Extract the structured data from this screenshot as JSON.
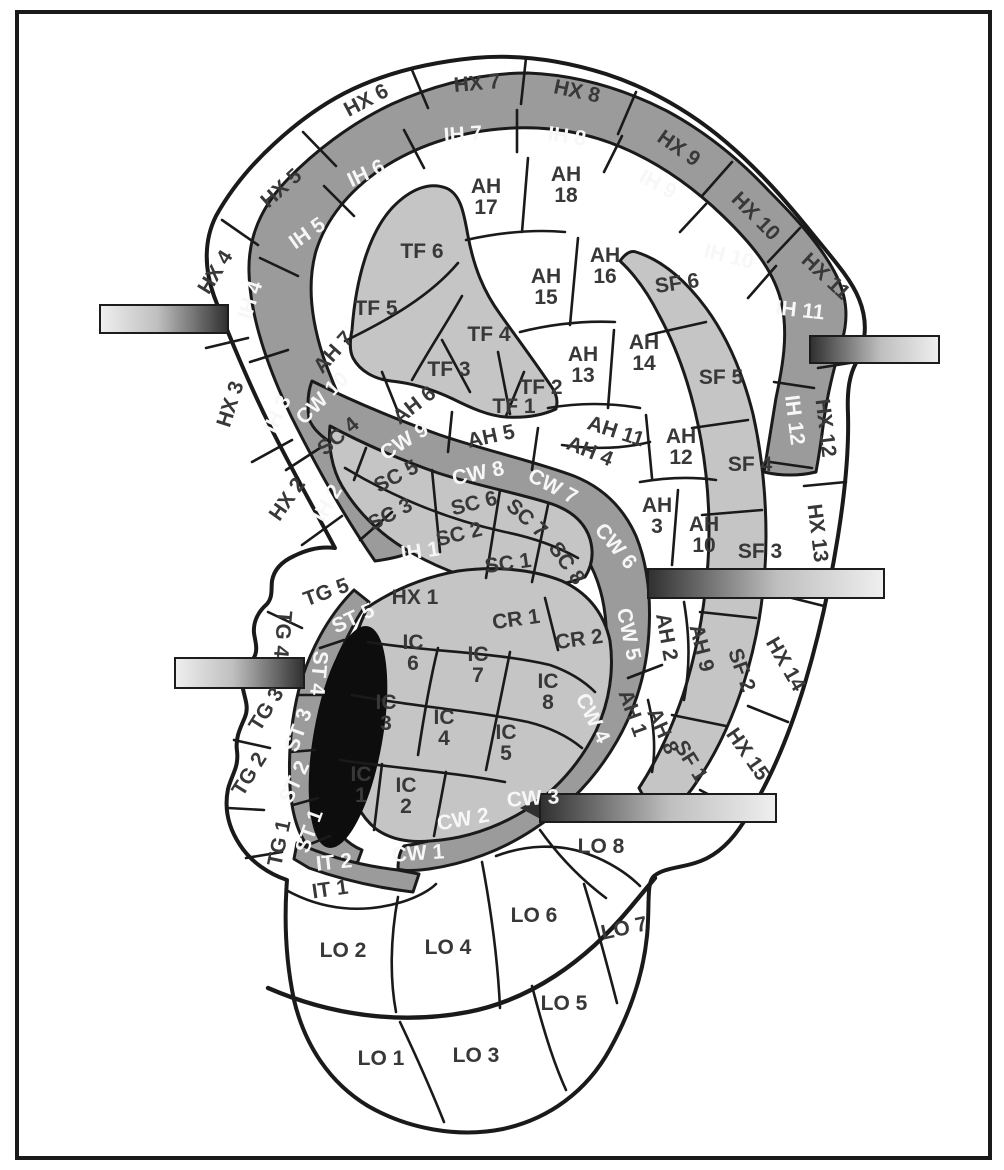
{
  "figure": {
    "kind": "auricular-zone-map"
  },
  "palette": {
    "ink": "#1a1a1a",
    "paper": "#ffffff",
    "dark_band": "#9b9b9b",
    "light_band": "#c5c5c5",
    "label_dark": "#383838",
    "label_light": "#f7f7f7",
    "pin_dark": "#2f2f2f",
    "pin_mid": "#bfbfbf",
    "pin_light": "#efefef"
  },
  "pins": [
    {
      "name": "pin-marker-1",
      "x": 100,
      "y": 305,
      "w": 128,
      "h": 28,
      "dir": "light-to-dark"
    },
    {
      "name": "pin-marker-2",
      "x": 810,
      "y": 336,
      "w": 129,
      "h": 27,
      "dir": "dark-to-light"
    },
    {
      "name": "pin-marker-3",
      "x": 648,
      "y": 569,
      "w": 236,
      "h": 29,
      "dir": "dark-to-light"
    },
    {
      "name": "pin-marker-4",
      "x": 175,
      "y": 658,
      "w": 129,
      "h": 30,
      "dir": "light-to-dark"
    },
    {
      "name": "pin-marker-5",
      "x": 540,
      "y": 794,
      "w": 236,
      "h": 28,
      "dir": "dark-to-light",
      "tip": true
    }
  ],
  "zones": [
    {
      "t": "HX 1",
      "x": 415,
      "y": 597,
      "r": 0,
      "c": "d"
    },
    {
      "t": "HX 2",
      "x": 287,
      "y": 499,
      "r": -55,
      "c": "d"
    },
    {
      "t": "HX 3",
      "x": 230,
      "y": 404,
      "r": -72,
      "c": "d"
    },
    {
      "t": "HX 4",
      "x": 215,
      "y": 272,
      "r": -58,
      "c": "d"
    },
    {
      "t": "HX 5",
      "x": 281,
      "y": 188,
      "r": -42,
      "c": "d"
    },
    {
      "t": "HX 6",
      "x": 366,
      "y": 100,
      "r": -28,
      "c": "d"
    },
    {
      "t": "HX 7",
      "x": 477,
      "y": 83,
      "r": -5,
      "c": "d"
    },
    {
      "t": "HX 8",
      "x": 577,
      "y": 91,
      "r": 12,
      "c": "d"
    },
    {
      "t": "HX 9",
      "x": 679,
      "y": 148,
      "r": 35,
      "c": "d"
    },
    {
      "t": "HX 10",
      "x": 756,
      "y": 216,
      "r": 45,
      "c": "d"
    },
    {
      "t": "HX 11",
      "x": 826,
      "y": 276,
      "r": 43,
      "c": "d"
    },
    {
      "t": "HX 12",
      "x": 826,
      "y": 428,
      "r": 83,
      "c": "d"
    },
    {
      "t": "HX 13",
      "x": 818,
      "y": 533,
      "r": 83,
      "c": "d"
    },
    {
      "t": "HX 14",
      "x": 786,
      "y": 664,
      "r": 60,
      "c": "d"
    },
    {
      "t": "HX 15",
      "x": 748,
      "y": 754,
      "r": 55,
      "c": "d"
    },
    {
      "t": "IH 1",
      "x": 420,
      "y": 551,
      "r": -8,
      "c": "w"
    },
    {
      "t": "IH 2",
      "x": 327,
      "y": 503,
      "r": -60,
      "c": "w"
    },
    {
      "t": "IH 3",
      "x": 277,
      "y": 414,
      "r": -65,
      "c": "w"
    },
    {
      "t": "IH 4",
      "x": 250,
      "y": 300,
      "r": -72,
      "c": "w"
    },
    {
      "t": "IH 5",
      "x": 307,
      "y": 233,
      "r": -35,
      "c": "w"
    },
    {
      "t": "IH 6",
      "x": 366,
      "y": 173,
      "r": -25,
      "c": "w"
    },
    {
      "t": "IH 7",
      "x": 463,
      "y": 134,
      "r": -4,
      "c": "w"
    },
    {
      "t": "IH 8",
      "x": 567,
      "y": 136,
      "r": 8,
      "c": "w"
    },
    {
      "t": "IH 9",
      "x": 658,
      "y": 184,
      "r": 28,
      "c": "w"
    },
    {
      "t": "IH 10",
      "x": 729,
      "y": 256,
      "r": 14,
      "c": "w"
    },
    {
      "t": "IH 11",
      "x": 800,
      "y": 310,
      "r": 6,
      "c": "w"
    },
    {
      "t": "IH 12",
      "x": 795,
      "y": 420,
      "r": 83,
      "c": "w"
    },
    {
      "t": "TF 1",
      "x": 514,
      "y": 406,
      "r": 0,
      "c": "d"
    },
    {
      "t": "TF 2",
      "x": 541,
      "y": 387,
      "r": 0,
      "c": "d"
    },
    {
      "t": "TF 3",
      "x": 449,
      "y": 369,
      "r": 0,
      "c": "d"
    },
    {
      "t": "TF 4",
      "x": 489,
      "y": 334,
      "r": 0,
      "c": "d"
    },
    {
      "t": "TF 5",
      "x": 376,
      "y": 308,
      "r": 0,
      "c": "d"
    },
    {
      "t": "TF 6",
      "x": 422,
      "y": 251,
      "r": 0,
      "c": "d"
    },
    {
      "t": [
        "AH",
        "17"
      ],
      "x": 486,
      "y": 196,
      "r": 0,
      "c": "d"
    },
    {
      "t": [
        "AH",
        "18"
      ],
      "x": 566,
      "y": 184,
      "r": 0,
      "c": "d"
    },
    {
      "t": [
        "AH",
        "15"
      ],
      "x": 546,
      "y": 286,
      "r": 0,
      "c": "d"
    },
    {
      "t": [
        "AH",
        "16"
      ],
      "x": 605,
      "y": 265,
      "r": 0,
      "c": "d"
    },
    {
      "t": [
        "AH",
        "13"
      ],
      "x": 583,
      "y": 364,
      "r": 0,
      "c": "d"
    },
    {
      "t": [
        "AH",
        "14"
      ],
      "x": 644,
      "y": 352,
      "r": 0,
      "c": "d"
    },
    {
      "t": "AH 11",
      "x": 616,
      "y": 431,
      "r": 18,
      "c": "d"
    },
    {
      "t": [
        "AH",
        "12"
      ],
      "x": 681,
      "y": 446,
      "r": 0,
      "c": "d"
    },
    {
      "t": [
        "AH",
        "3"
      ],
      "x": 657,
      "y": 515,
      "r": 0,
      "c": "d"
    },
    {
      "t": [
        "AH",
        "10"
      ],
      "x": 704,
      "y": 534,
      "r": 0,
      "c": "d"
    },
    {
      "t": "AH 4",
      "x": 590,
      "y": 451,
      "r": 22,
      "c": "d"
    },
    {
      "t": "AH 5",
      "x": 491,
      "y": 436,
      "r": -12,
      "c": "d"
    },
    {
      "t": "AH 6",
      "x": 414,
      "y": 405,
      "r": -38,
      "c": "d"
    },
    {
      "t": "AH 7",
      "x": 333,
      "y": 352,
      "r": -48,
      "c": "d"
    },
    {
      "t": "AH 2",
      "x": 667,
      "y": 637,
      "r": 80,
      "c": "d"
    },
    {
      "t": "AH 9",
      "x": 702,
      "y": 648,
      "r": 76,
      "c": "d"
    },
    {
      "t": "AH 1",
      "x": 633,
      "y": 713,
      "r": 70,
      "c": "d"
    },
    {
      "t": "AH 8",
      "x": 663,
      "y": 731,
      "r": 66,
      "c": "d"
    },
    {
      "t": "SF 1",
      "x": 691,
      "y": 761,
      "r": 58,
      "c": "d"
    },
    {
      "t": "SF 2",
      "x": 742,
      "y": 670,
      "r": 70,
      "c": "d"
    },
    {
      "t": "SF 3",
      "x": 760,
      "y": 551,
      "r": 0,
      "c": "d"
    },
    {
      "t": "SF 4",
      "x": 750,
      "y": 464,
      "r": 0,
      "c": "d"
    },
    {
      "t": "SF 5",
      "x": 721,
      "y": 377,
      "r": 0,
      "c": "d"
    },
    {
      "t": "SF 6",
      "x": 677,
      "y": 283,
      "r": -8,
      "c": "d"
    },
    {
      "t": "SC 1",
      "x": 508,
      "y": 563,
      "r": -8,
      "c": "d"
    },
    {
      "t": "SC 2",
      "x": 459,
      "y": 534,
      "r": -14,
      "c": "d"
    },
    {
      "t": "SC 3",
      "x": 390,
      "y": 514,
      "r": -28,
      "c": "d"
    },
    {
      "t": "SC 4",
      "x": 338,
      "y": 436,
      "r": -40,
      "c": "d"
    },
    {
      "t": "SC 5",
      "x": 396,
      "y": 476,
      "r": -28,
      "c": "d"
    },
    {
      "t": "SC 6",
      "x": 474,
      "y": 503,
      "r": -14,
      "c": "d"
    },
    {
      "t": "SC 7",
      "x": 527,
      "y": 518,
      "r": 42,
      "c": "d"
    },
    {
      "t": "SC 8",
      "x": 567,
      "y": 563,
      "r": 55,
      "c": "d"
    },
    {
      "t": "CR 1",
      "x": 516,
      "y": 619,
      "r": -8,
      "c": "d"
    },
    {
      "t": "CR 2",
      "x": 579,
      "y": 639,
      "r": -8,
      "c": "d"
    },
    {
      "t": "CW 1",
      "x": 418,
      "y": 853,
      "r": -4,
      "c": "w"
    },
    {
      "t": "CW 2",
      "x": 463,
      "y": 819,
      "r": -10,
      "c": "w"
    },
    {
      "t": "CW 3",
      "x": 533,
      "y": 798,
      "r": -4,
      "c": "w"
    },
    {
      "t": "CW 4",
      "x": 593,
      "y": 718,
      "r": 64,
      "c": "w"
    },
    {
      "t": "CW 5",
      "x": 629,
      "y": 634,
      "r": 78,
      "c": "w"
    },
    {
      "t": "CW 6",
      "x": 616,
      "y": 546,
      "r": 50,
      "c": "w"
    },
    {
      "t": "CW 7",
      "x": 553,
      "y": 486,
      "r": 28,
      "c": "w"
    },
    {
      "t": "CW 8",
      "x": 478,
      "y": 473,
      "r": -12,
      "c": "w"
    },
    {
      "t": "CW 9",
      "x": 404,
      "y": 441,
      "r": -32,
      "c": "w"
    },
    {
      "t": "CW 10",
      "x": 322,
      "y": 398,
      "r": -45,
      "c": "w"
    },
    {
      "t": [
        "IC",
        "6"
      ],
      "x": 413,
      "y": 652,
      "r": 0,
      "c": "d"
    },
    {
      "t": [
        "IC",
        "7"
      ],
      "x": 478,
      "y": 664,
      "r": 0,
      "c": "d"
    },
    {
      "t": [
        "IC",
        "8"
      ],
      "x": 548,
      "y": 691,
      "r": 0,
      "c": "d"
    },
    {
      "t": [
        "IC",
        "3"
      ],
      "x": 386,
      "y": 712,
      "r": 0,
      "c": "d"
    },
    {
      "t": [
        "IC",
        "4"
      ],
      "x": 444,
      "y": 727,
      "r": 0,
      "c": "d"
    },
    {
      "t": [
        "IC",
        "5"
      ],
      "x": 506,
      "y": 742,
      "r": 0,
      "c": "d"
    },
    {
      "t": [
        "IC",
        "1"
      ],
      "x": 361,
      "y": 784,
      "r": 0,
      "c": "d"
    },
    {
      "t": [
        "IC",
        "2"
      ],
      "x": 406,
      "y": 795,
      "r": 0,
      "c": "d"
    },
    {
      "t": "ST 1",
      "x": 309,
      "y": 831,
      "r": -70,
      "c": "w"
    },
    {
      "t": "ST 2",
      "x": 294,
      "y": 782,
      "r": -65,
      "c": "w"
    },
    {
      "t": "ST 3",
      "x": 298,
      "y": 730,
      "r": -70,
      "c": "w"
    },
    {
      "t": "ST 4",
      "x": 319,
      "y": 673,
      "r": 95,
      "c": "w"
    },
    {
      "t": "ST 5",
      "x": 353,
      "y": 618,
      "r": -25,
      "c": "w"
    },
    {
      "t": "TG 1",
      "x": 279,
      "y": 843,
      "r": -78,
      "c": "d"
    },
    {
      "t": "TG 2",
      "x": 249,
      "y": 774,
      "r": -58,
      "c": "d"
    },
    {
      "t": "TG 3",
      "x": 266,
      "y": 709,
      "r": -58,
      "c": "d"
    },
    {
      "t": "TG 4",
      "x": 283,
      "y": 634,
      "r": 95,
      "c": "d"
    },
    {
      "t": "TG 5",
      "x": 326,
      "y": 592,
      "r": -20,
      "c": "d"
    },
    {
      "t": "IT 1",
      "x": 330,
      "y": 889,
      "r": -8,
      "c": "d"
    },
    {
      "t": "IT 2",
      "x": 334,
      "y": 862,
      "r": -6,
      "c": "w"
    },
    {
      "t": "LO 1",
      "x": 381,
      "y": 1058,
      "r": 0,
      "c": "d"
    },
    {
      "t": "LO 2",
      "x": 343,
      "y": 950,
      "r": 0,
      "c": "d"
    },
    {
      "t": "LO 3",
      "x": 476,
      "y": 1055,
      "r": 0,
      "c": "d"
    },
    {
      "t": "LO 4",
      "x": 448,
      "y": 947,
      "r": 0,
      "c": "d"
    },
    {
      "t": "LO 5",
      "x": 564,
      "y": 1003,
      "r": 0,
      "c": "d"
    },
    {
      "t": "LO 6",
      "x": 534,
      "y": 915,
      "r": 0,
      "c": "d"
    },
    {
      "t": "LO 7",
      "x": 624,
      "y": 928,
      "r": -12,
      "c": "d"
    },
    {
      "t": "LO 8",
      "x": 601,
      "y": 846,
      "r": 0,
      "c": "d"
    }
  ]
}
